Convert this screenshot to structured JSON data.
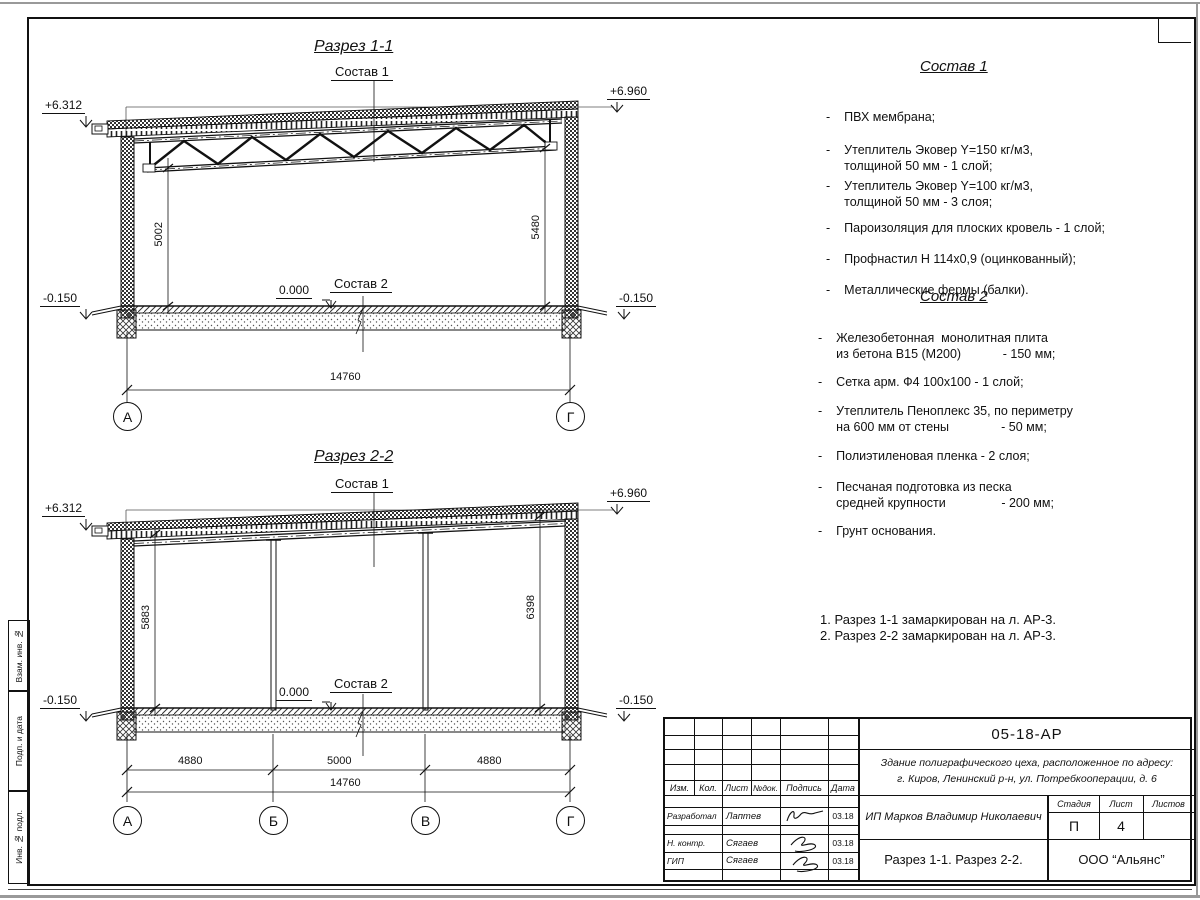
{
  "section1": {
    "title": "Разрез 1-1",
    "label_sostav1": "Состав 1",
    "label_sostav2": "Состав 2",
    "elev_left": "+6.312",
    "elev_right": "+6.960",
    "elev_zero": "0.000",
    "elev_minus_left": "-0.150",
    "elev_minus_right": "-0.150",
    "dim_left": "5002",
    "dim_right": "5480",
    "dim_total": "14760",
    "axis_left": "А",
    "axis_right": "Г"
  },
  "section2": {
    "title": "Разрез 2-2",
    "label_sostav1": "Состав 1",
    "label_sostav2": "Состав 2",
    "elev_left": "+6.312",
    "elev_right": "+6.960",
    "elev_zero": "0.000",
    "elev_minus_left": "-0.150",
    "elev_minus_right": "-0.150",
    "dim_left": "5883",
    "dim_right": "6398",
    "dim_spans": [
      "4880",
      "5000",
      "4880"
    ],
    "dim_total": "14760",
    "axes": [
      "А",
      "Б",
      "В",
      "Г"
    ]
  },
  "sostav1": {
    "title": "Состав 1",
    "items": [
      {
        "b": "-",
        "t": "ПВХ мембрана;"
      },
      {
        "b": "-",
        "t": "Утеплитель Эковер Y=150 кг/м3,\nтолщиной 50 мм - 1 слой;"
      },
      {
        "b": "-",
        "t": "Утеплитель Эковер Y=100 кг/м3,\nтолщиной 50 мм - 3 слоя;"
      },
      {
        "b": "-",
        "t": "Пароизоляция для плоских кровель - 1 слой;"
      },
      {
        "b": "-",
        "t": "Профнастил Н 114х0,9 (оцинкованный);"
      },
      {
        "b": "-",
        "t": "Металлические фермы (балки)."
      }
    ]
  },
  "sostav2": {
    "title": "Состав 2",
    "items": [
      {
        "b": "-",
        "t": "Железобетонная  монолитная плита\nиз бетона В15 (М200)            - 150 мм;"
      },
      {
        "b": "-",
        "t": "Сетка арм. Ф4 100х100 - 1 слой;"
      },
      {
        "b": "-",
        "t": "Утеплитель Пеноплекс 35, по периметру\nна 600 мм от стены               - 50 мм;"
      },
      {
        "b": "-",
        "t": "Полиэтиленовая пленка - 2 слоя;"
      },
      {
        "b": "-",
        "t": "Песчаная подготовка из песка\nсредней крупности                - 200 мм;"
      },
      {
        "b": "-",
        "t": "Грунт основания."
      }
    ]
  },
  "notes": {
    "line1": "1. Разрез 1-1 замаркирован на л. АР-3.",
    "line2": "2. Разрез 2-2 замаркирован на л. АР-3."
  },
  "margin_labels": {
    "top": "Взам. инв. №",
    "middle": "Подп. и дата",
    "bottom": "Инв. № подл."
  },
  "titleblock": {
    "doc_code": "05-18-АР",
    "address_line1": "Здание полиграфического цеха, расположенное по адресу:",
    "address_line2": "г. Киров,  Ленинский р-н, ул. Потребкооперации, д. 6",
    "client": "ИП Марков Владимир Николаевич",
    "sheet_title": "Разрез 1-1. Разрез 2-2.",
    "company": "ООО “Альянс”",
    "col_izm": "Изм.",
    "col_kol": "Кол.",
    "col_list": "Лист",
    "col_ndok": "№док.",
    "col_podpis": "Подпись",
    "col_data": "Дата",
    "row1_role": "Разработал",
    "row1_name": "Лаптев",
    "row1_date": "03.18",
    "row2_role": "Н. контр.",
    "row2_name": "Сягаев",
    "row2_date": "03.18",
    "row3_role": "ГИП",
    "row3_name": "Сягаев",
    "row3_date": "03.18",
    "stage_label": "Стадия",
    "sheet_label": "Лист",
    "sheets_label": "Листов",
    "stage_value": "П",
    "sheet_value": "4",
    "sheets_value": ""
  }
}
